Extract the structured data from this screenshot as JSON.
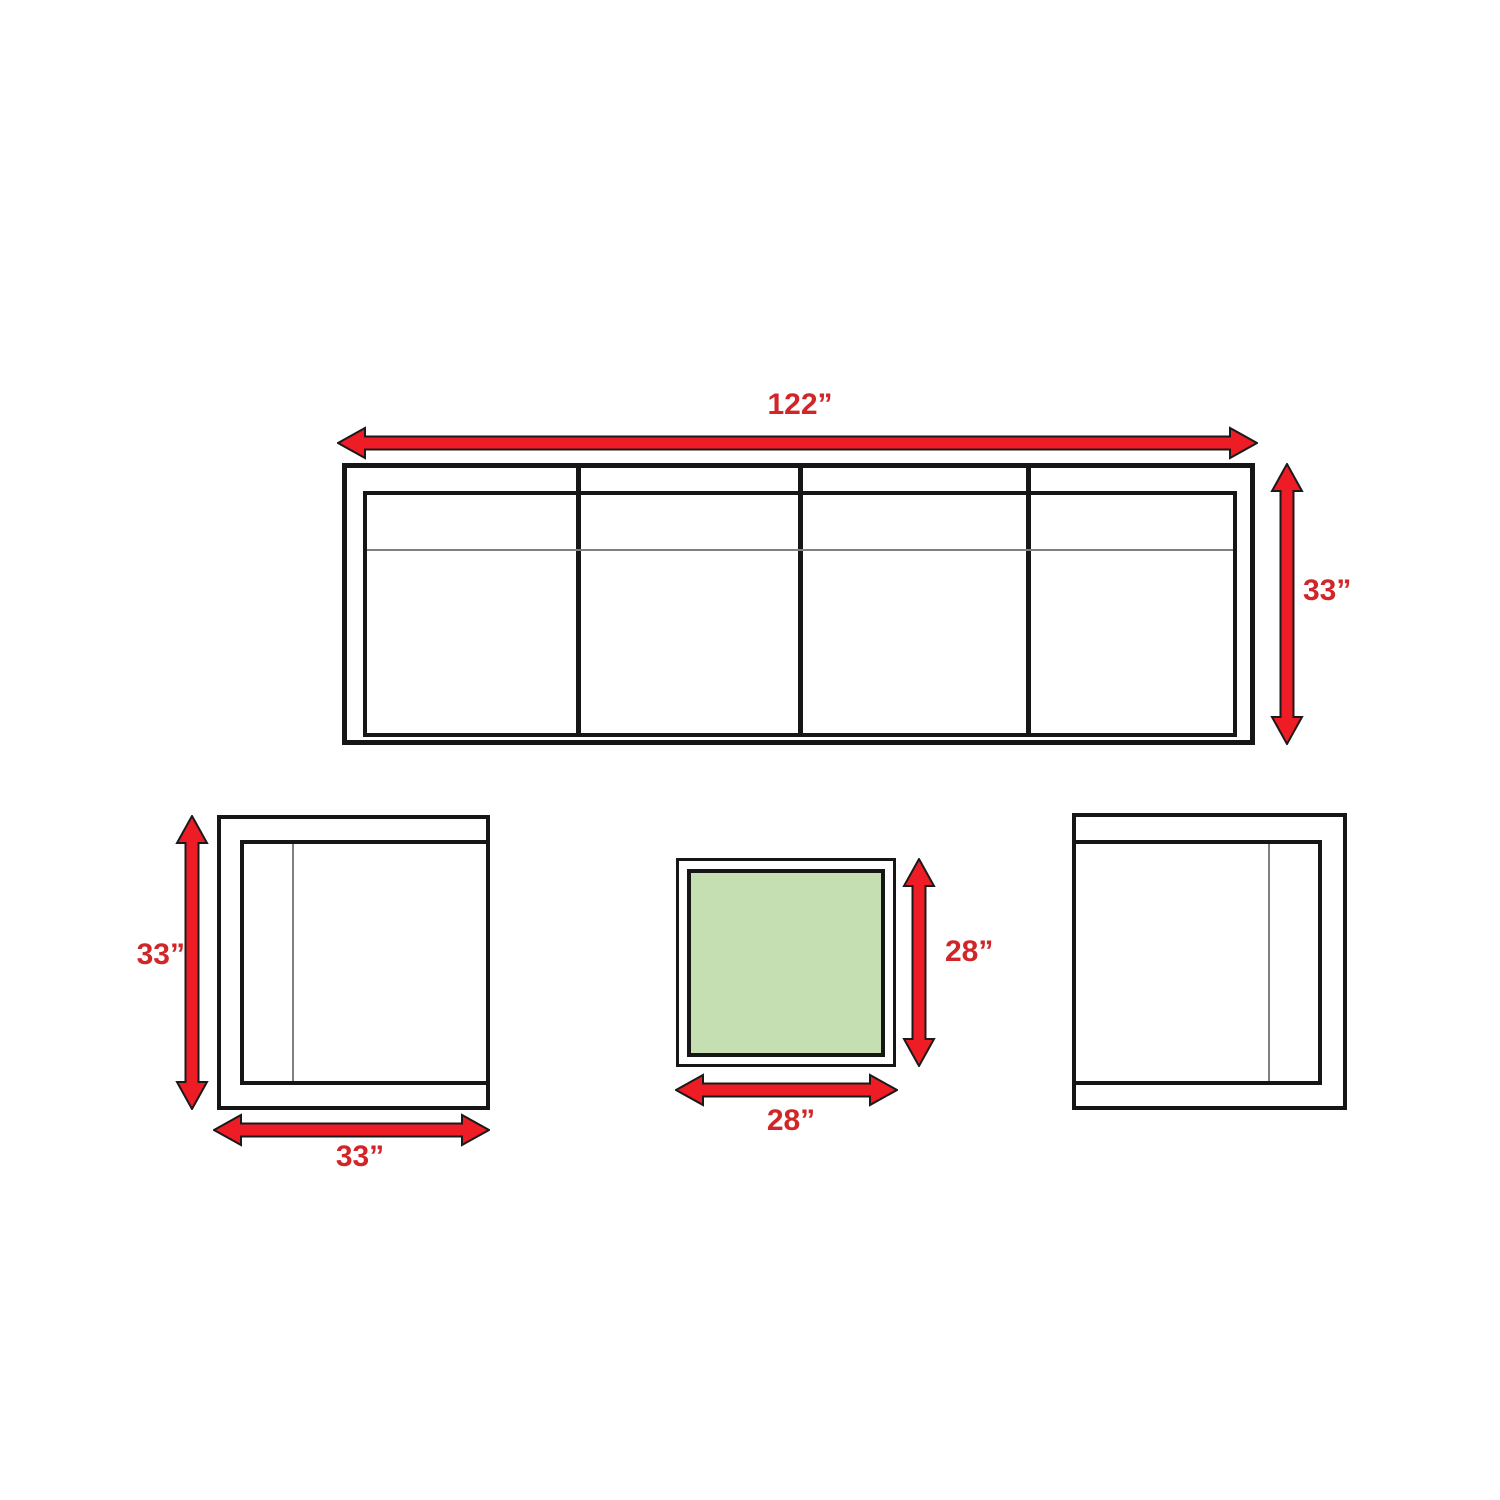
{
  "colors": {
    "background": "#ffffff",
    "line": "#161616",
    "seam": "#7f7f7f",
    "arrow_fill": "#ee1c25",
    "arrow_outline": "#1a1a1a",
    "label_text": "#d02629",
    "table_fill": "#c5dfb3"
  },
  "sofa": {
    "sections": 4,
    "width": {
      "label": "122”",
      "inches": 122
    },
    "height": {
      "label": "33”",
      "inches": 33
    }
  },
  "left_chair": {
    "height": {
      "label": "33”",
      "inches": 33
    },
    "width": {
      "label": "33”",
      "inches": 33
    }
  },
  "coffee_table": {
    "height": {
      "label": "28”",
      "inches": 28
    },
    "width": {
      "label": "28”",
      "inches": 28
    }
  },
  "right_chair": {}
}
